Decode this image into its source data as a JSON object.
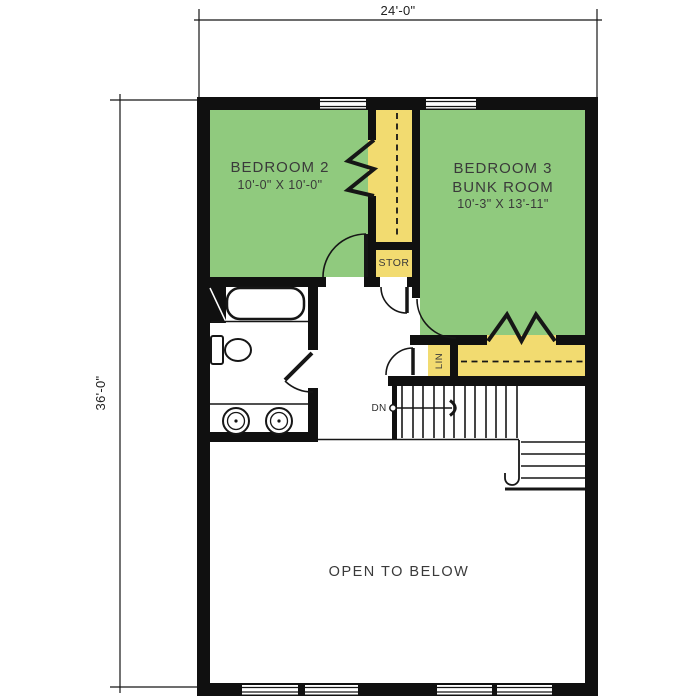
{
  "title": "Upper Floor Plan",
  "colors": {
    "room_green": "#90CA7E",
    "closet_yellow": "#F2DB70",
    "wall": "#101010",
    "line": "#161616",
    "text": "#3A3A3A",
    "background": "#FFFFFF"
  },
  "dimensions": {
    "width_label": "24'-0\"",
    "height_label": "36'-0\""
  },
  "rooms": {
    "bedroom2": {
      "name": "BEDROOM 2",
      "size": "10'-0\" X 10'-0\""
    },
    "bedroom3": {
      "name": "BEDROOM 3",
      "subtitle": "BUNK ROOM",
      "size": "10'-3\" X 13'-11\""
    },
    "storage": {
      "name": "STOR"
    },
    "linen": {
      "name": "LIN"
    },
    "open_below": {
      "name": "OPEN TO BELOW"
    },
    "stairs": {
      "direction_label": "DN"
    }
  }
}
